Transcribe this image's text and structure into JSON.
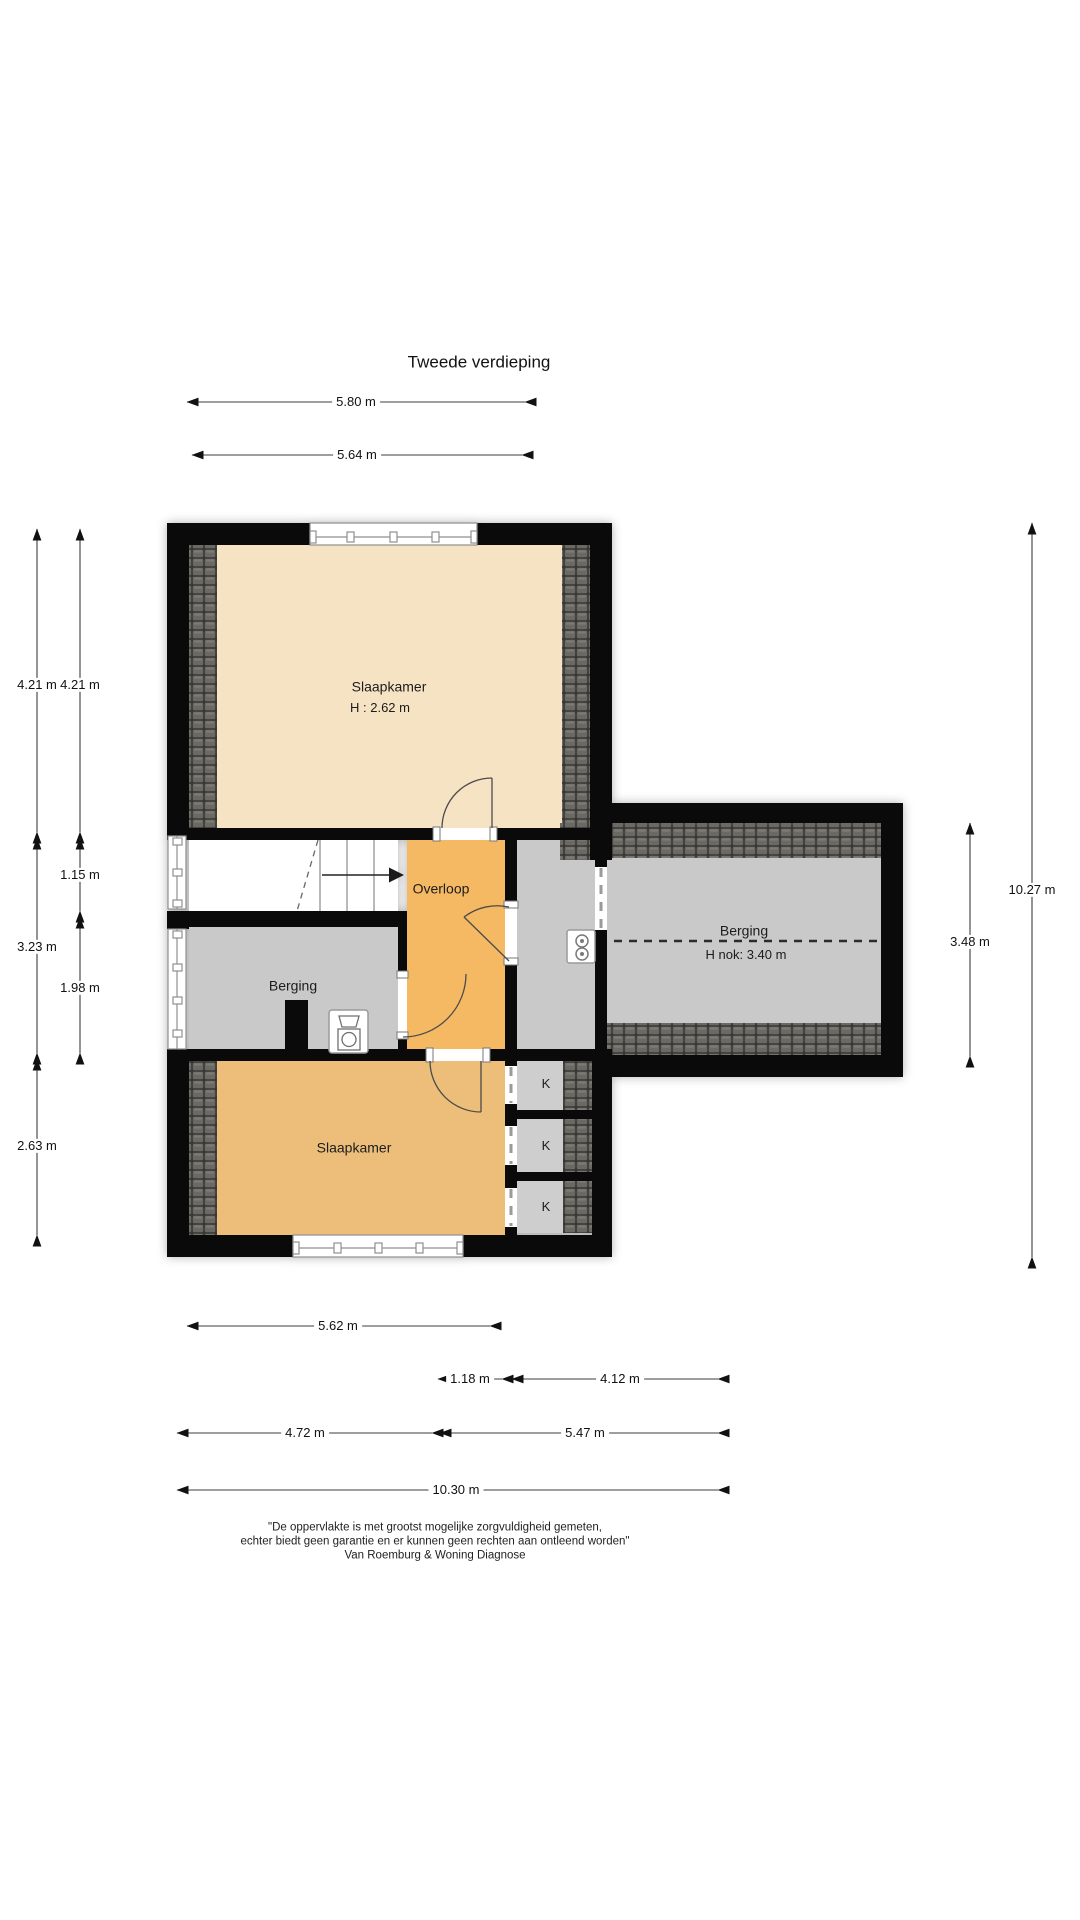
{
  "title": "Tweede verdieping",
  "rooms": {
    "slaapkamer_top": {
      "name": "Slaapkamer",
      "height": "H : 2.62 m"
    },
    "overloop": {
      "name": "Overloop"
    },
    "berging_left": {
      "name": "Berging"
    },
    "berging_right": {
      "name": "Berging",
      "ridge_height": "H nok: 3.40 m"
    },
    "slaapkamer_bottom": {
      "name": "Slaapkamer"
    },
    "closet": {
      "label": "K"
    }
  },
  "dimensions": {
    "top": [
      "5.80 m",
      "5.64 m"
    ],
    "left_outer": [
      "4.21 m",
      "3.23 m",
      "2.63 m"
    ],
    "left_inner": [
      "4.21 m",
      "1.15 m",
      "1.98 m"
    ],
    "right": [
      "3.48 m",
      "10.27 m"
    ],
    "bottom": [
      "5.62 m",
      "1.18 m",
      "4.12 m",
      "4.72 m",
      "5.47 m",
      "10.30 m"
    ]
  },
  "footer": {
    "line1": "\"De oppervlakte is met grootst mogelijke zorgvuldigheid gemeten,",
    "line2": "echter biedt geen garantie en er kunnen geen rechten aan ontleend worden\"",
    "line3": "Van Roemburg & Woning Diagnose"
  },
  "colors": {
    "wall": "#0a0a0a",
    "bedroom_top": "#f6e3c4",
    "landing": "#f5b963",
    "bedroom_bottom": "#ecbe7a",
    "storage_gray": "#c9c9c9",
    "roof_tile": "#6b6964"
  }
}
